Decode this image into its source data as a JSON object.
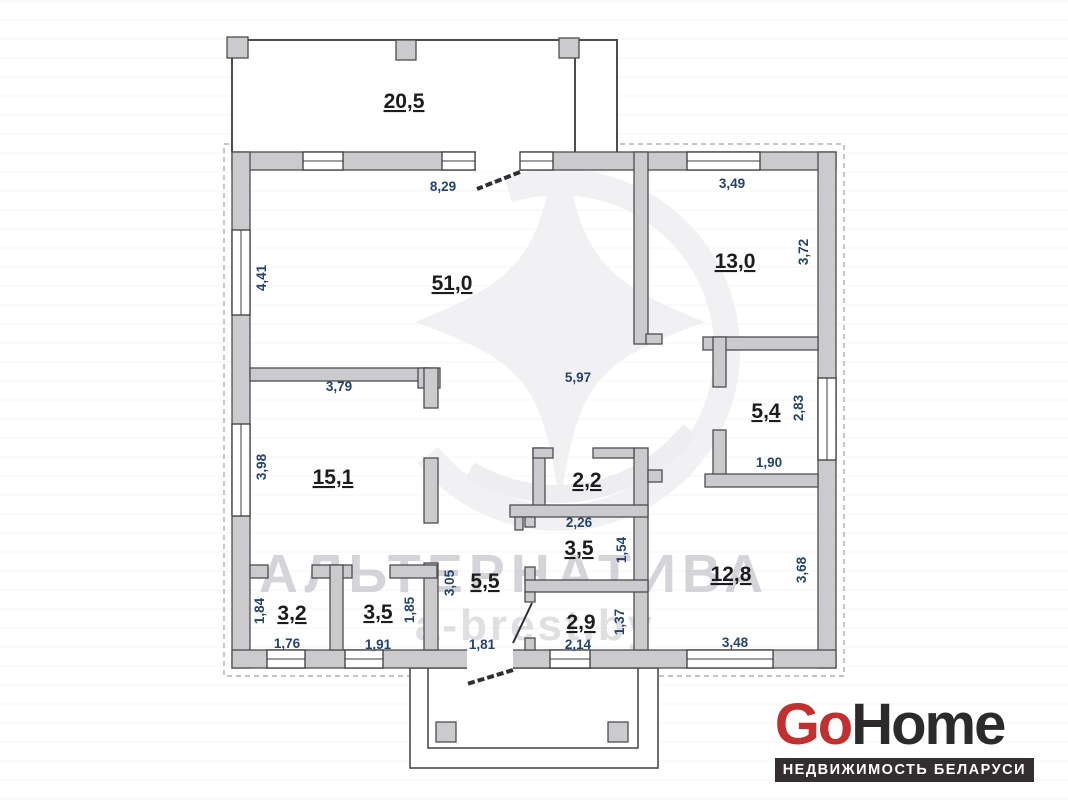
{
  "plan": {
    "rooms": [
      {
        "id": "terrace",
        "area": "20,5"
      },
      {
        "id": "living-room",
        "area": "51,0"
      },
      {
        "id": "bedroom-top-right",
        "area": "13,0"
      },
      {
        "id": "storage-right",
        "area": "5,4"
      },
      {
        "id": "bedroom-left",
        "area": "15,1"
      },
      {
        "id": "wc-center",
        "area": "2,2"
      },
      {
        "id": "bath-center",
        "area": "3,5"
      },
      {
        "id": "hallway",
        "area": "5,5"
      },
      {
        "id": "bedroom-bottom-right",
        "area": "12,8"
      },
      {
        "id": "closet-left",
        "area": "3,2"
      },
      {
        "id": "closet-mid",
        "area": "3,5"
      },
      {
        "id": "lobby",
        "area": "2,9"
      }
    ],
    "dims": [
      {
        "id": "living-width",
        "text": "8,29"
      },
      {
        "id": "bedroom-tr-width",
        "text": "3,49"
      },
      {
        "id": "living-height",
        "text": "4,41"
      },
      {
        "id": "bedroom-tr-height",
        "text": "3,72"
      },
      {
        "id": "corridor-length",
        "text": "5,97"
      },
      {
        "id": "storage-height",
        "text": "2,83"
      },
      {
        "id": "bedroom-left-width",
        "text": "3,79"
      },
      {
        "id": "storage-width",
        "text": "1,90"
      },
      {
        "id": "bedroom-left-height",
        "text": "3,98"
      },
      {
        "id": "bath-width",
        "text": "2,26"
      },
      {
        "id": "bath-height",
        "text": "1,54"
      },
      {
        "id": "hall-height",
        "text": "3,05"
      },
      {
        "id": "closet-mid-height",
        "text": "1,85"
      },
      {
        "id": "closet-left-height",
        "text": "1,84"
      },
      {
        "id": "bedroom-br-height",
        "text": "3,68"
      },
      {
        "id": "closet-left-width",
        "text": "1,76"
      },
      {
        "id": "closet-mid-width",
        "text": "1,91"
      },
      {
        "id": "hall-width",
        "text": "1,81"
      },
      {
        "id": "lobby-width",
        "text": "2,14"
      },
      {
        "id": "lobby-height",
        "text": "1,37"
      },
      {
        "id": "bedroom-br-width",
        "text": "3,48"
      }
    ]
  },
  "watermark": {
    "brand": "АЛЬТЕРНАТИВА",
    "site": "a-brest.by"
  },
  "logo": {
    "go": "Go",
    "home": "Home",
    "tagline": "НЕДВИЖИМОСТЬ БЕЛАРУСИ",
    "accent_color": "#c0302e",
    "dark_color": "#2d2a2b"
  }
}
